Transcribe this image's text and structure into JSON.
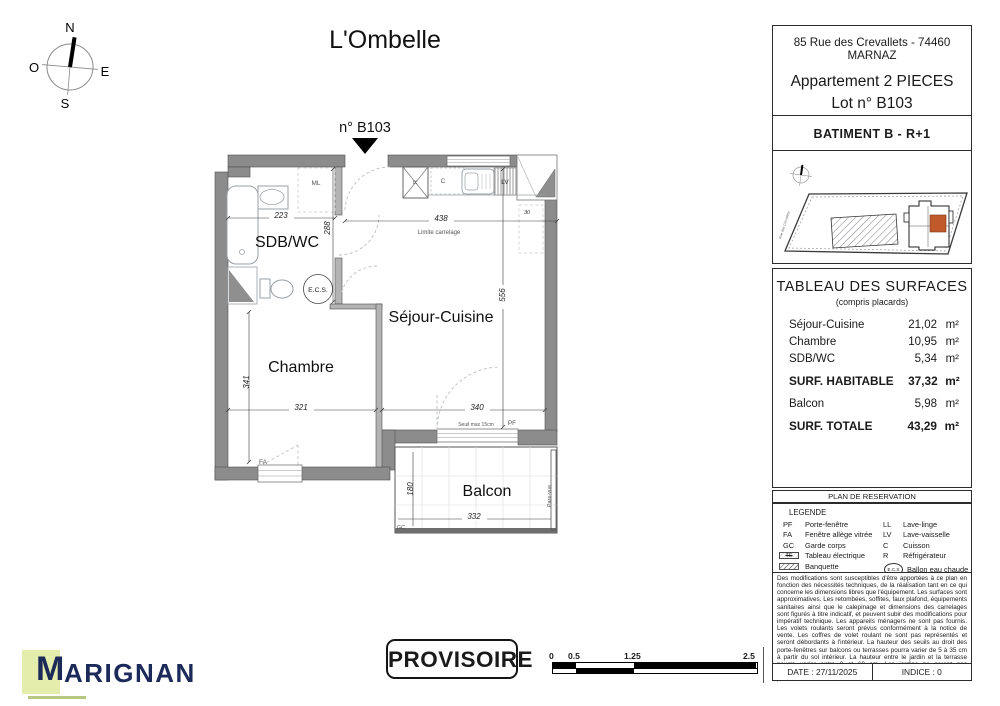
{
  "title": "L'Ombelle",
  "compass": {
    "n": "N",
    "e": "E",
    "s": "S",
    "o": "O"
  },
  "plan": {
    "unit_label": "n° B103",
    "rooms": {
      "sdb": "SDB/WC",
      "chambre": "Chambre",
      "sejour": "Séjour-Cuisine",
      "balcon": "Balcon"
    },
    "dims": {
      "sdb_w": "223",
      "sdb_h": "288",
      "sejour_w": "438",
      "sejour_h": "556",
      "right_sill": "30",
      "chambre_h": "341",
      "chambre_w": "321",
      "sejour_s": "340",
      "balcon_h": "180",
      "balcon_w": "332"
    },
    "labels": {
      "ml": "ML",
      "cuisson": "C",
      "lv": "LV",
      "refrigerateur": "R",
      "pf": "PF",
      "fa": "FA",
      "gc": "GC",
      "ecs": "E.C.S.",
      "limite_carrelage": "Limite carrelage",
      "seuil": "Seuil max 15cm",
      "pare_vue": "Pare-vue"
    }
  },
  "info_panel": {
    "address": "85 Rue des Crevallets - 74460 MARNAZ",
    "apartment_type": "Appartement 2 PIECES",
    "lot": "Lot n° B103",
    "batiment": "BATIMENT B -  R+1",
    "site_street": "Rue des Crevallets",
    "surfaces": {
      "title": "TABLEAU DES SURFACES",
      "subtitle": "(compris placards)",
      "rows": [
        {
          "label": "Séjour-Cuisine",
          "area": "21,02",
          "unit": "m²"
        },
        {
          "label": "Chambre",
          "area": "10,95",
          "unit": "m²"
        },
        {
          "label": "SDB/WC",
          "area": "5,34",
          "unit": "m²"
        },
        {
          "label": "SURF. HABITABLE",
          "area": "37,32",
          "unit": "m²"
        },
        {
          "label": "Balcon",
          "area": "5,98",
          "unit": "m²"
        },
        {
          "label": "SURF. TOTALE",
          "area": "43,29",
          "unit": "m²"
        }
      ]
    },
    "reservation_title": "PLAN DE RESERVATION",
    "legend": {
      "title": "LEGENDE",
      "left": [
        {
          "code": "PF",
          "label": "Porte-fenêtre"
        },
        {
          "code": "FA",
          "label": "Fenêtre allège vitrée"
        },
        {
          "code": "GC",
          "label": "Garde corps"
        },
        {
          "code": "TE",
          "label": "Tableau électrique"
        },
        {
          "code": "",
          "label": "Banquette"
        },
        {
          "code": "",
          "label": "Soffites et faux-plafond"
        }
      ],
      "right": [
        {
          "code": "LL",
          "label": "Lave-linge"
        },
        {
          "code": "LV",
          "label": "Lave-vaisselle"
        },
        {
          "code": "C",
          "label": "Cuisson"
        },
        {
          "code": "R",
          "label": "Réfrigérateur"
        },
        {
          "code": "E.C.S",
          "label": "Ballon eau chaude"
        }
      ]
    },
    "disclaimer": "Des modifications sont susceptibles d'être apportées à ce plan en fonction des nécessités techniques, de la réalisation tant en ce qui concerne les dimensions libres que l'équipement. Les surfaces sont approximatives. Les retombées, soffites, faux plafond, équipements sanitaires ainsi que le calepinage et dimensions des carrelages sont figurés à titre indicatif, et peuvent subir des modifications pour impératif technique. Les appareils ménagers ne sont pas fournis. Les volets roulants seront prévus conformément à la notice de vente. Les coffres de volet roulant ne sont pas représentés et seront débordants à l'intérieur. La hauteur des seuils au droit des porte-fenêtres sur balcons ou terrasses pourra varier de 5 à 35 cm à partir du sol intérieur. La hauteur entre le jardin et la terrasse pourra varier entre 0 et 60 cm. Les jardins ne seront pas nécessairement plats et pourront comporter des talus et des pentes.",
    "date": "DATE : 27/11/2025",
    "indice": "INDICE : 0"
  },
  "footer": {
    "logo_m": "M",
    "logo_rest": "ARIGNAN",
    "stamp": "PROVISOIRE",
    "scale_labels": [
      "0",
      "0.5",
      "1.25",
      "2.5"
    ]
  },
  "colors": {
    "accent_unit": "#c05a2a",
    "logo_navy": "#1c2a5a",
    "logo_leaf": "#e4edac",
    "wall_gray": "#8c8c8c"
  }
}
